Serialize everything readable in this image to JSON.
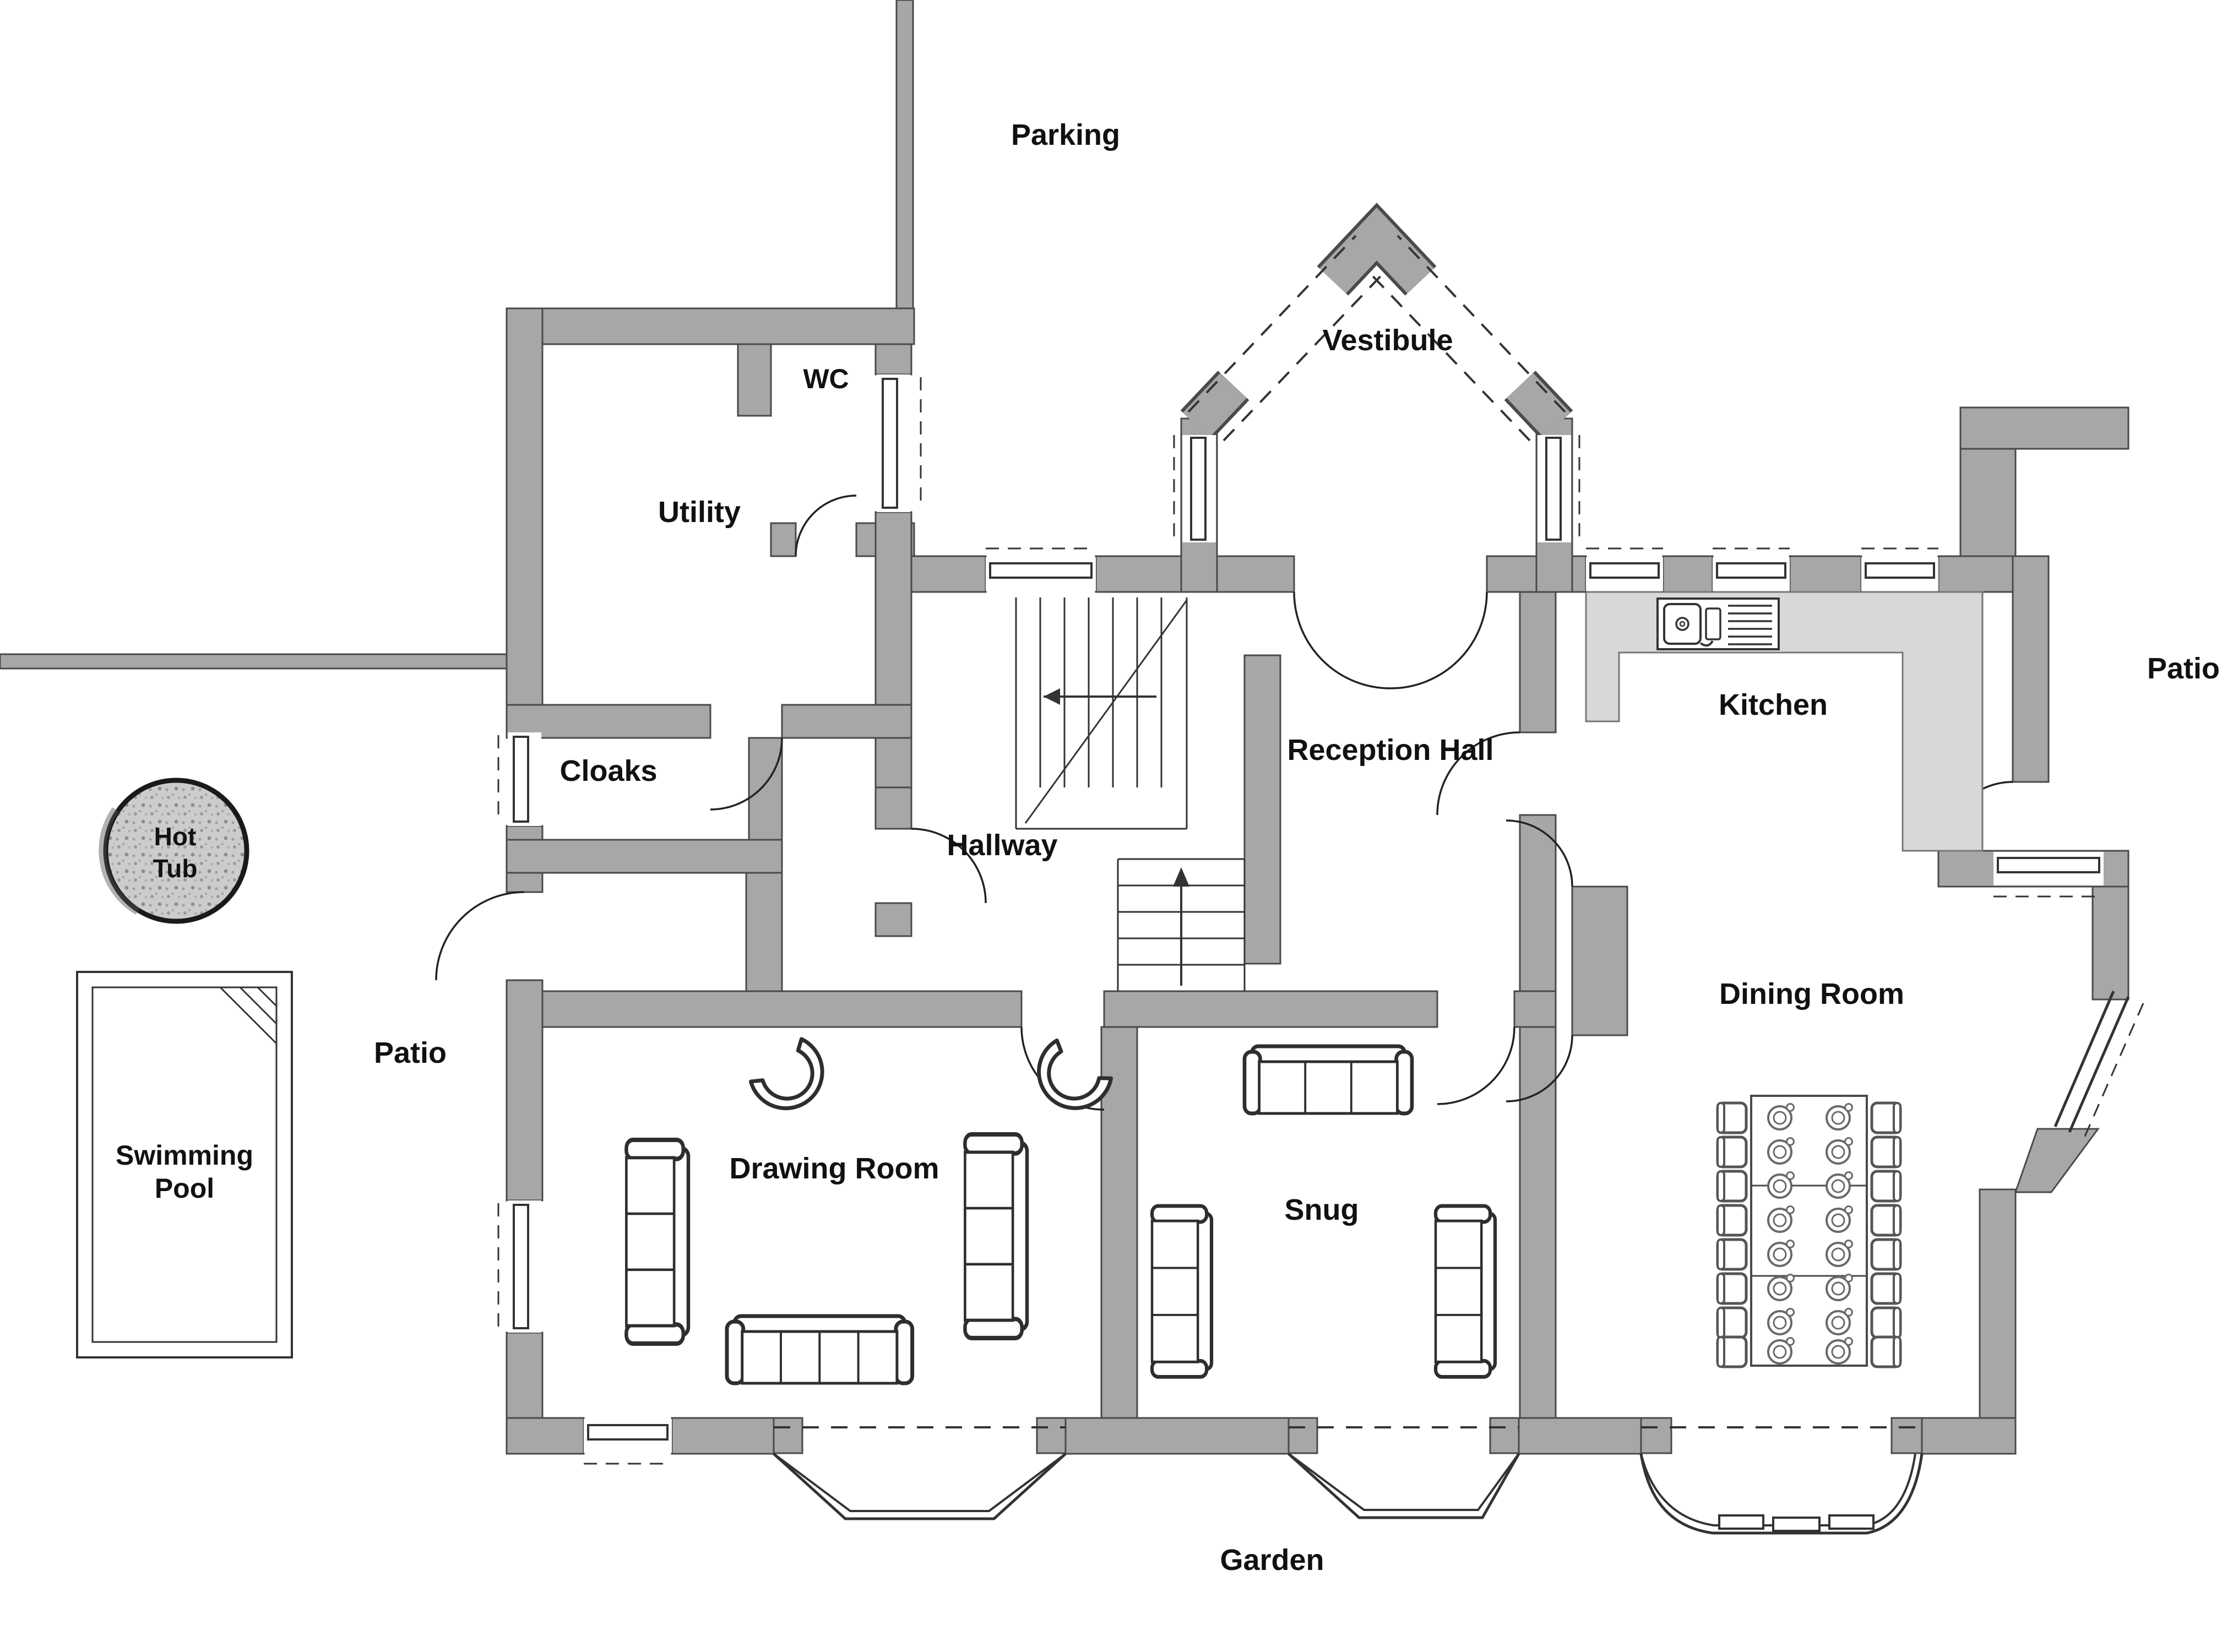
{
  "title": "Ground floor plan",
  "labels": {
    "parking": "Parking",
    "vestibule": "Vestibule",
    "wc": "WC",
    "utility": "Utility",
    "cloaks": "Cloaks",
    "hallway": "Hallway",
    "reception_hall": "Reception Hall",
    "kitchen": "Kitchen",
    "patio_right": "Patio",
    "patio_left": "Patio",
    "hot_tub_line1": "Hot",
    "hot_tub_line2": "Tub",
    "swimming_pool_line1": "Swimming",
    "swimming_pool_line2": "Pool",
    "drawing_room": "Drawing Room",
    "snug": "Snug",
    "dining_room": "Dining Room",
    "garden": "Garden"
  },
  "colors": {
    "wall": "#a7a7a7",
    "wall_outline": "#4a4a4a",
    "counter": "#d8d8d8",
    "furniture_outline": "#2e2e2e",
    "text": "#111111",
    "background": "#ffffff"
  },
  "features": {
    "stairs": "L-shaped staircase with up arrow and landing arrow",
    "bay_windows": 3,
    "dining_seats": 16,
    "sofas_drawing_room": 3,
    "armchairs_drawing_room": 2,
    "sofas_snug": 3
  }
}
